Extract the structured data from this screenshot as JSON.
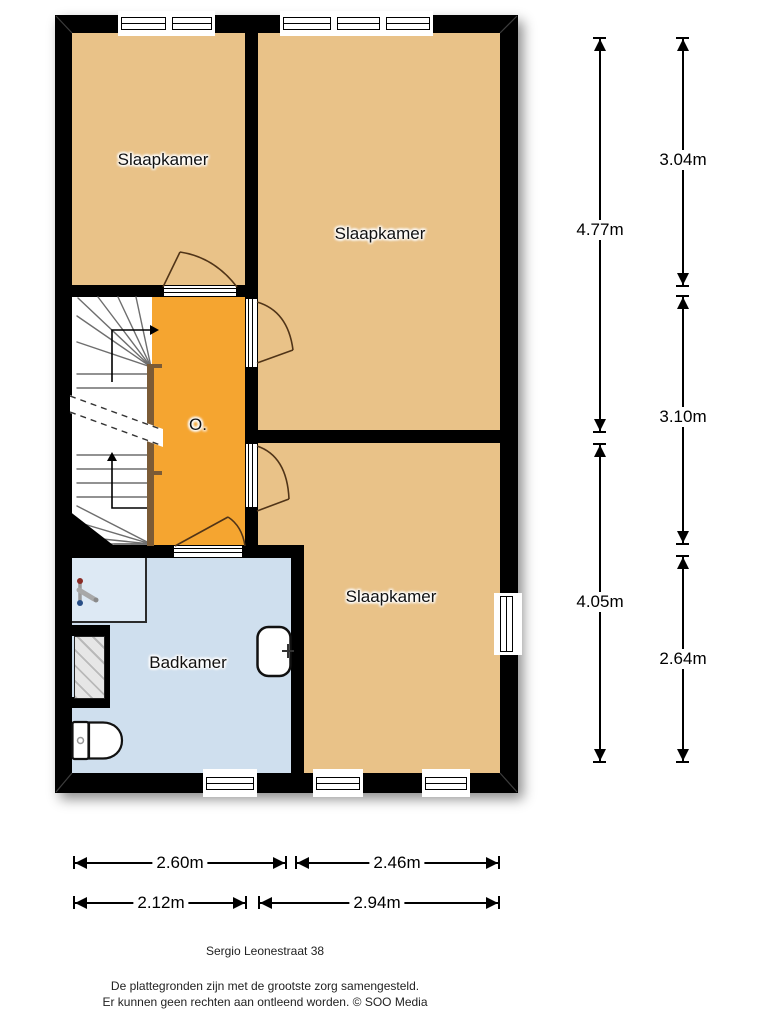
{
  "floorplan": {
    "rooms": [
      {
        "id": "bedroom-top-left",
        "label": "Slaapkamer"
      },
      {
        "id": "bedroom-top-right",
        "label": "Slaapkamer"
      },
      {
        "id": "landing",
        "label": "O."
      },
      {
        "id": "bathroom",
        "label": "Badkamer"
      },
      {
        "id": "bedroom-bottom",
        "label": "Slaapkamer"
      }
    ],
    "dimensions": {
      "right_outer": [
        "4.77m",
        "4.05m"
      ],
      "right_inner": [
        "3.04m",
        "3.10m",
        "2.64m"
      ],
      "bottom_upper": [
        "2.60m",
        "2.46m"
      ],
      "bottom_lower": [
        "2.12m",
        "2.94m"
      ]
    },
    "footer": {
      "address": "Sergio Leonestraat 38",
      "disclaimer_line1": "De plattegronden zijn met de grootste zorg samengesteld.",
      "disclaimer_line2": "Er kunnen geen rechten aan ontleend worden. © SOO Media"
    },
    "colors": {
      "wall": "#000000",
      "room_fill": "#e9c288",
      "landing_fill": "#f5a530",
      "bathroom_fill": "#cfdfee",
      "shower_fill": "#dde9f4",
      "stairs_fill": "#ffffff",
      "handrail": "#7b5b36",
      "door_swing": "#503418"
    }
  }
}
